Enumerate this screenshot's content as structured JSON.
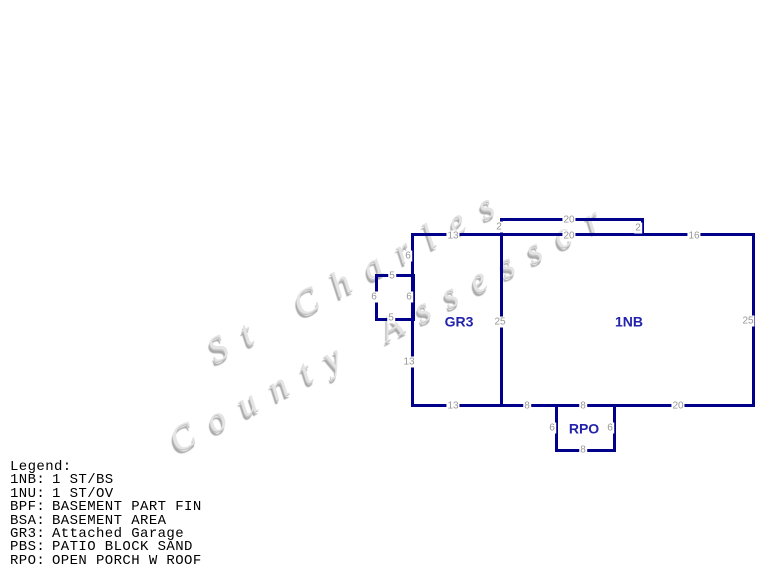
{
  "watermark": {
    "line1": "St Charles",
    "line2": "County Assessor"
  },
  "sketch": {
    "line_color": "#00008B",
    "dimension_label_color": "#979797",
    "area_label_color": "#2222AA",
    "area_labels": [
      {
        "text": "GR3",
        "x": 459,
        "y": 322
      },
      {
        "text": "1NB",
        "x": 629,
        "y": 322
      },
      {
        "text": "RPO",
        "x": 584,
        "y": 429
      }
    ],
    "dimension_labels": [
      {
        "text": "20",
        "x": 569,
        "y": 220
      },
      {
        "text": "2",
        "x": 499,
        "y": 227
      },
      {
        "text": "2",
        "x": 638,
        "y": 228
      },
      {
        "text": "13",
        "x": 453,
        "y": 236
      },
      {
        "text": "20",
        "x": 569,
        "y": 236
      },
      {
        "text": "16",
        "x": 694,
        "y": 236
      },
      {
        "text": "6",
        "x": 408,
        "y": 256
      },
      {
        "text": "5",
        "x": 392,
        "y": 276
      },
      {
        "text": "6",
        "x": 374,
        "y": 297
      },
      {
        "text": "6",
        "x": 409,
        "y": 297
      },
      {
        "text": "5",
        "x": 391,
        "y": 318
      },
      {
        "text": "25",
        "x": 500,
        "y": 322
      },
      {
        "text": "25",
        "x": 748,
        "y": 321
      },
      {
        "text": "13",
        "x": 409,
        "y": 362
      },
      {
        "text": "13",
        "x": 453,
        "y": 406
      },
      {
        "text": "8",
        "x": 527,
        "y": 406
      },
      {
        "text": "8",
        "x": 583,
        "y": 406
      },
      {
        "text": "20",
        "x": 678,
        "y": 406
      },
      {
        "text": "6",
        "x": 552,
        "y": 428
      },
      {
        "text": "6",
        "x": 610,
        "y": 428
      },
      {
        "text": "8",
        "x": 583,
        "y": 450
      }
    ]
  },
  "legend": {
    "title": "Legend:",
    "entries": [
      {
        "abbr": "1NB:",
        "desc": "1 ST/BS"
      },
      {
        "abbr": "1NU:",
        "desc": "1 ST/OV"
      },
      {
        "abbr": "BPF:",
        "desc": "BASEMENT PART FIN"
      },
      {
        "abbr": "BSA:",
        "desc": "BASEMENT AREA"
      },
      {
        "abbr": "GR3:",
        "desc": "Attached Garage"
      },
      {
        "abbr": "PBS:",
        "desc": "PATIO BLOCK SAND"
      },
      {
        "abbr": "RPO:",
        "desc": "OPEN PORCH W ROOF"
      }
    ]
  }
}
